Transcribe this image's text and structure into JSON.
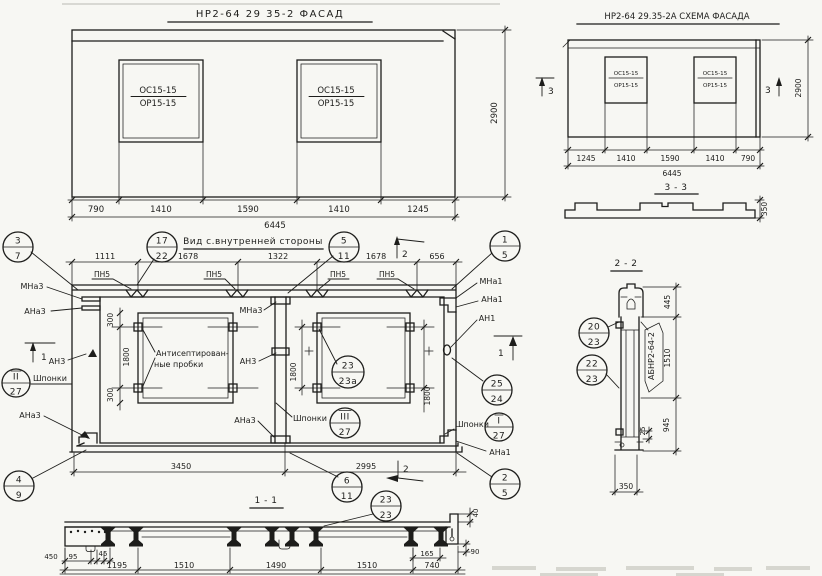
{
  "colors": {
    "ink": "#1d1d1b",
    "paper": "#f7f7f3",
    "faint": "#c7c7bf"
  },
  "facade": {
    "title": "НР2-64 29 35-2  ФАСАД",
    "window": {
      "top": "ОС15-15",
      "bottom": "ОР15-15"
    },
    "dims_bottom": [
      "790",
      "1410",
      "1590",
      "1410",
      "1245"
    ],
    "dim_total": "6445",
    "dim_height": "2900"
  },
  "schema": {
    "title": "НР2-64 29.35-2А  СХЕМА ФАСАДА",
    "window": {
      "top": "ОС15-15",
      "bottom": "ОР15-15"
    },
    "dims_bottom": [
      "1245",
      "1410",
      "1590",
      "1410",
      "790"
    ],
    "dim_total": "6445",
    "dim_height": "2900",
    "marker": "3"
  },
  "section33": {
    "title": "3 - 3",
    "thickness": "350"
  },
  "inner": {
    "title": "Вид с.внутренней стороны",
    "dims_top": [
      "1111",
      "1678",
      "1322",
      "1678",
      "656"
    ],
    "pn5": "ПН5",
    "note1": "Антисептирован-",
    "note2": "ные пробки",
    "shponki": "Шпонки",
    "dim300": "300",
    "dim1800": "1800",
    "dims_bottom": [
      "3450",
      "2995"
    ],
    "mna3": "МНа3",
    "ana3": "АНа3",
    "an3": "АН3",
    "mna1": "МНа1",
    "ana1": "АНа1",
    "an1": "АН1",
    "marker1": "1",
    "marker2": "2",
    "dim40": "40"
  },
  "section11": {
    "title": "1 - 1",
    "dims_small_left": [
      "450",
      "95",
      "45"
    ],
    "dim165": "165",
    "dim90": "90",
    "dims_bottom": [
      "1195",
      "1510",
      "1490",
      "1510",
      "740"
    ]
  },
  "section22": {
    "title": "2 - 2",
    "dim445": "445",
    "dim1510": "1510",
    "dim25": "25",
    "dim945": "945",
    "dim350": "350",
    "mark": "АБНР2-64-2"
  },
  "circles": {
    "c3_7": {
      "t": "3",
      "b": "7"
    },
    "c17_22": {
      "t": "17",
      "b": "22"
    },
    "c5_11": {
      "t": "5",
      "b": "11"
    },
    "c1_5": {
      "t": "1",
      "b": "5"
    },
    "cII_27": {
      "t": "II",
      "b": "27"
    },
    "cIII_27": {
      "t": "III",
      "b": "27"
    },
    "cI_27": {
      "t": "I",
      "b": "27"
    },
    "c25_24": {
      "t": "25",
      "b": "24"
    },
    "c4_9": {
      "t": "4",
      "b": "9"
    },
    "c6_11": {
      "t": "6",
      "b": "11"
    },
    "c23_23a": {
      "t": "23",
      "b": "23а"
    },
    "c2_5": {
      "t": "2",
      "b": "5"
    },
    "c23_23": {
      "t": "23",
      "b": "23"
    },
    "c20_23": {
      "t": "20",
      "b": "23"
    },
    "c22_23": {
      "t": "22",
      "b": "23"
    }
  }
}
